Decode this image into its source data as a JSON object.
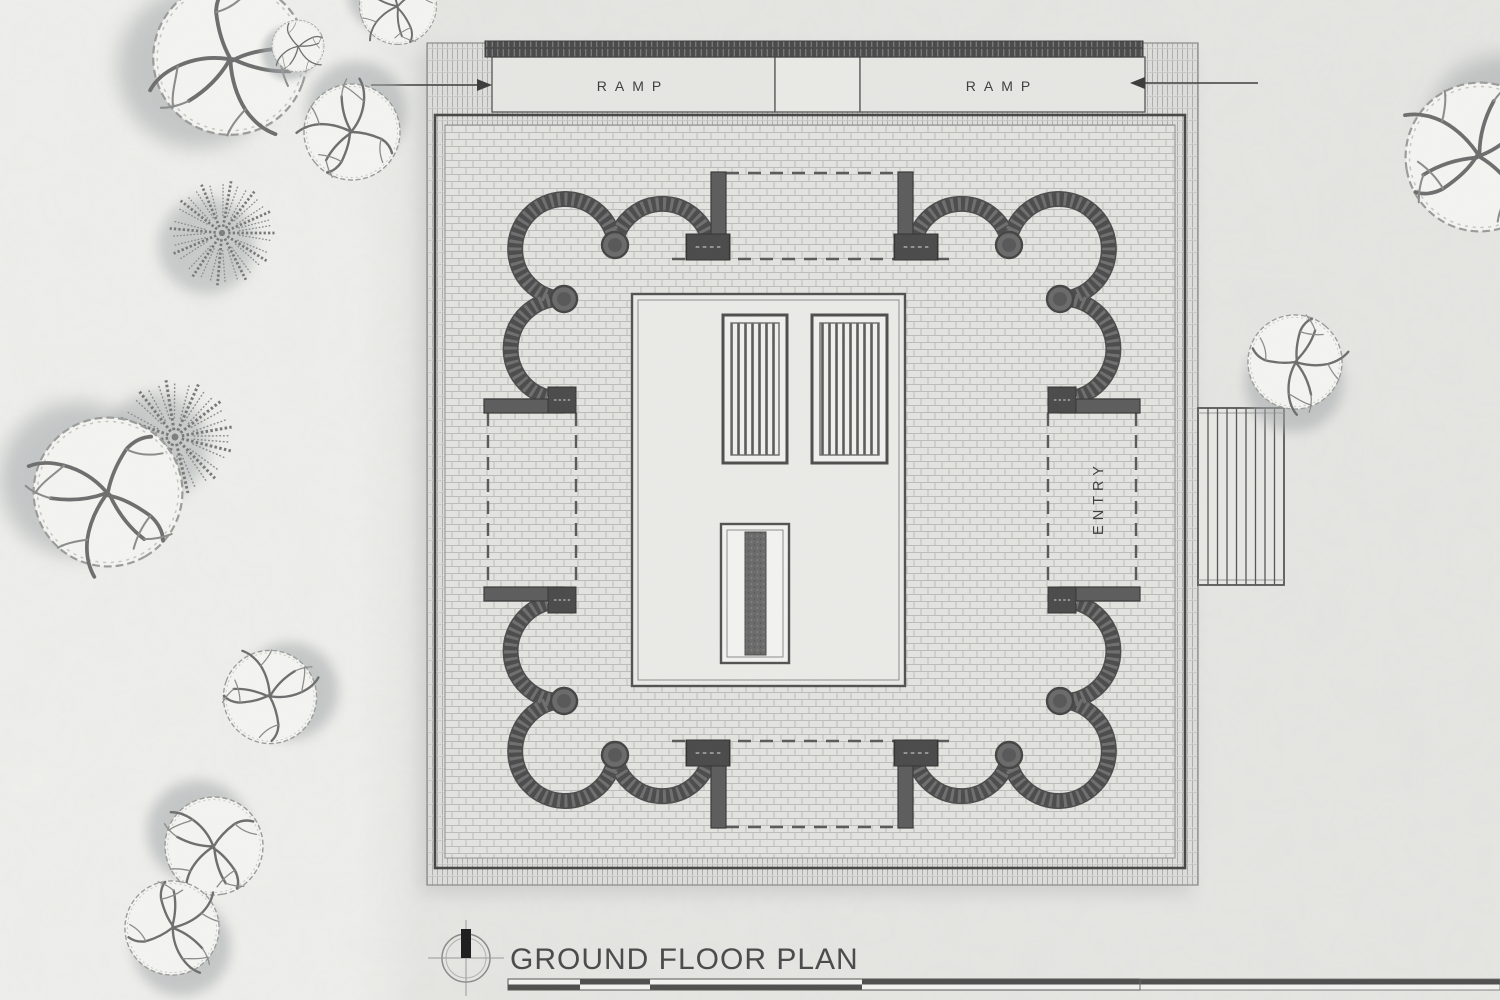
{
  "drawing": {
    "title": "GROUND FLOOR PLAN"
  },
  "annotations": {
    "ramp_left": "RAMP",
    "ramp_right": "RAMP",
    "entry": "ENTRY"
  },
  "palette": {
    "paper": "#e6e6e3",
    "paper_light": "#eeeeec",
    "ink_dark": "#474747",
    "wall_fill": "#4a4a4a",
    "brick_joint": "#bcbcba",
    "dashed_line": "#5a5a5a",
    "tree_shadow": "#a4a9ab",
    "north_marker": "#1e1e1e"
  }
}
